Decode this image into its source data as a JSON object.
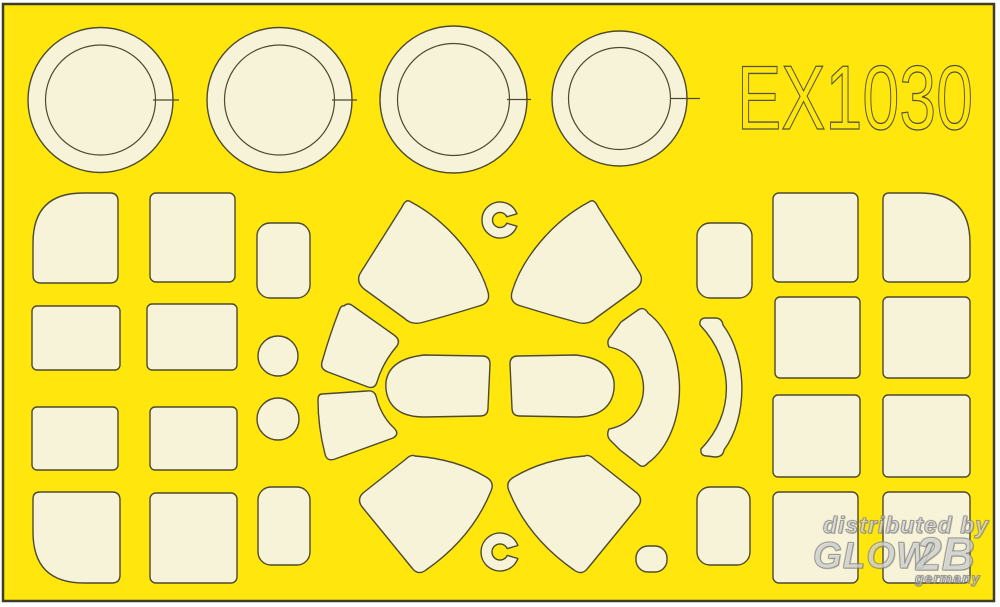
{
  "sheet": {
    "product_code": "EX1030",
    "colors": {
      "background": "#ffffff",
      "sheet_yellow": "#ffe60d",
      "mask_cream": "#f7f3d8",
      "cut_outline": "#4d4a30",
      "code_stroke": "#55543a",
      "watermark_gray": "#9a9a9a"
    },
    "mask_inventory": {
      "wheel_ring_masks": 4,
      "left_panel_masks": 8,
      "right_panel_masks": 8,
      "small_tab_masks": 4,
      "small_disc_masks": 2,
      "canopy_piece_masks": 10,
      "c_ring_masks": 2,
      "small_oval_masks": 1
    }
  },
  "watermark": {
    "line1": "distributed by",
    "brand": "GLOW",
    "brand_suffix": "2B",
    "country": "germany"
  }
}
